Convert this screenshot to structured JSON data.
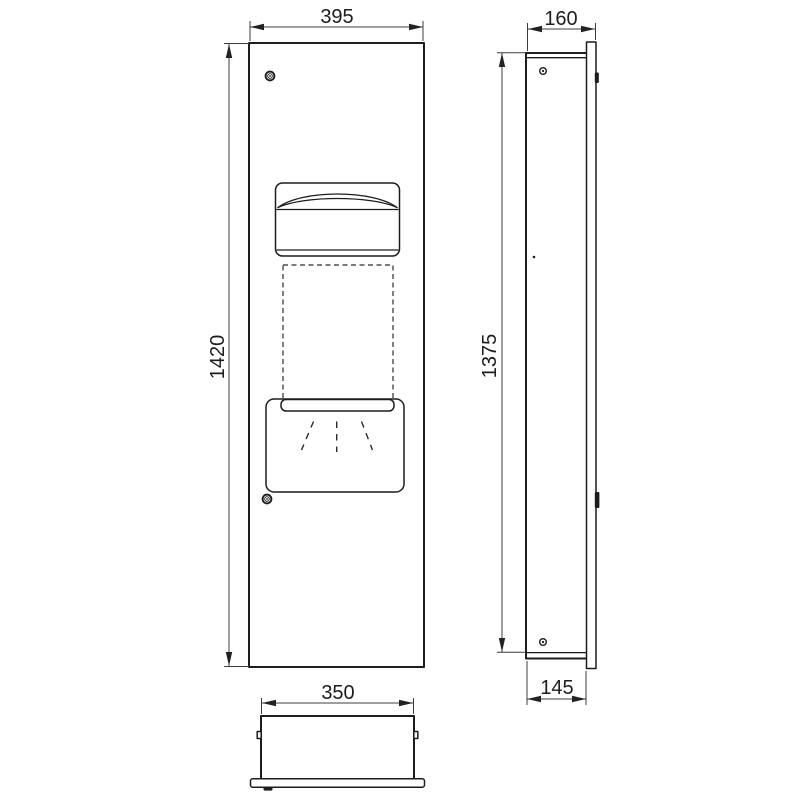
{
  "drawing": {
    "background": "#ffffff",
    "object_line_color": "#1d1d1b",
    "dimension_line_color": "#3d3d3d",
    "text_color": "#1d1d1b",
    "views": {
      "front": {
        "width_label": "395",
        "height_label": "1420"
      },
      "side": {
        "depth_label": "160",
        "height_label": "1375",
        "recess_depth_label": "145"
      },
      "bottom": {
        "width_label": "350"
      }
    },
    "icons": {
      "screw": "screw-icon",
      "mounting_clip": "mounting-clip-icon",
      "hinge_dot": "hinge-dot-icon"
    }
  }
}
